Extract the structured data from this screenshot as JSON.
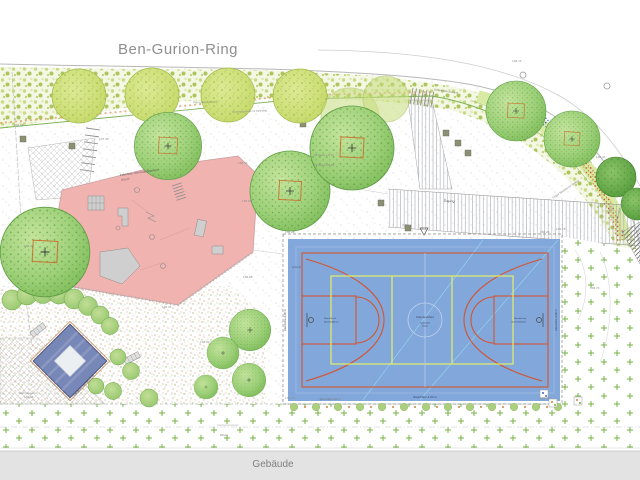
{
  "street": {
    "name": "Ben-Gurion-Ring"
  },
  "building": {
    "label": "Gebäude"
  },
  "areas": {
    "playground_label_line1": "Fallschutz- und Geländebereich",
    "playground_label_line2": "700 m²",
    "meadow_label": "Wiese",
    "neighbor_label": "Nachbargrundstück",
    "access_label": "Zugang",
    "planting_label": "Pflanzung Bestand",
    "slope_label": "Böschungskante für Spielplatz",
    "girls_garden_label": "Mädchengarten",
    "trampoline_label": "Trampolin mit Fallschutz",
    "stairs_label": "Treppe Bestand (11 Stufen)",
    "base_plate_label": "Bodenplatte Bestand",
    "gate_label": "Tor Bestand",
    "earth_wall_label": "Erdwall",
    "south_fence_label": "Zaunhöhe 2,00 m"
  },
  "court": {
    "center_label": "Kleinspielfeld",
    "hoop_label_line1": "Kleinfeld mit",
    "hoop_label_line2": "Basketballkorb",
    "fence_label_bottom": "Zaunhöhe 4,00 m",
    "fence_label_left": "Zaunhöhe 4,00 m",
    "fence_label_right": "Zaunhöhe 4,00 m"
  },
  "annotations": [
    {
      "text": "136.98",
      "x": 14,
      "y": 126
    },
    {
      "text": "137.48",
      "x": 99,
      "y": 140
    },
    {
      "text": "136.43",
      "x": 238,
      "y": 164
    },
    {
      "text": "136.28",
      "x": 242,
      "y": 202
    },
    {
      "text": "136.38",
      "x": 24,
      "y": 247
    },
    {
      "text": "136.25",
      "x": 243,
      "y": 278
    },
    {
      "text": "136.31",
      "x": 162,
      "y": 308
    },
    {
      "text": "136.28",
      "x": 57,
      "y": 340
    },
    {
      "text": "136.26",
      "x": 24,
      "y": 398
    },
    {
      "text": "136.30",
      "x": 200,
      "y": 343
    },
    {
      "text": "135.74",
      "x": 556,
      "y": 230
    },
    {
      "text": "136.74",
      "x": 590,
      "y": 289
    },
    {
      "text": "136.74",
      "x": 512,
      "y": 62
    },
    {
      "text": "136.44",
      "x": 596,
      "y": 158
    },
    {
      "text": "136.28",
      "x": 285,
      "y": 233
    },
    {
      "text": "136.23",
      "x": 540,
      "y": 233
    },
    {
      "text": "136.73",
      "x": 285,
      "y": 399
    },
    {
      "text": "136.43",
      "x": 540,
      "y": 399
    },
    {
      "text": "OK Mauer 137,10",
      "x": 314,
      "y": 156,
      "size": 2.5
    },
    {
      "text": "OK Mauer 136,95",
      "x": 314,
      "y": 166,
      "size": 2.5
    },
    {
      "text": "2,5%",
      "x": 402,
      "y": 226,
      "rot": 4
    },
    {
      "text": "2,5%",
      "x": 608,
      "y": 213,
      "rot": -35
    }
  ],
  "colors": {
    "court-blue": "#82a7db",
    "court-line-orange": "#d2552f",
    "court-line-yellow": "#e4ee67",
    "playground-pink": "#f0b3b0",
    "tree-green": "#7cba58",
    "tree-light-green": "#c3d765",
    "lawn-plus-green": "#76b245",
    "building-gray": "#e3e3e3",
    "diamond-blue": "#7787b8"
  }
}
